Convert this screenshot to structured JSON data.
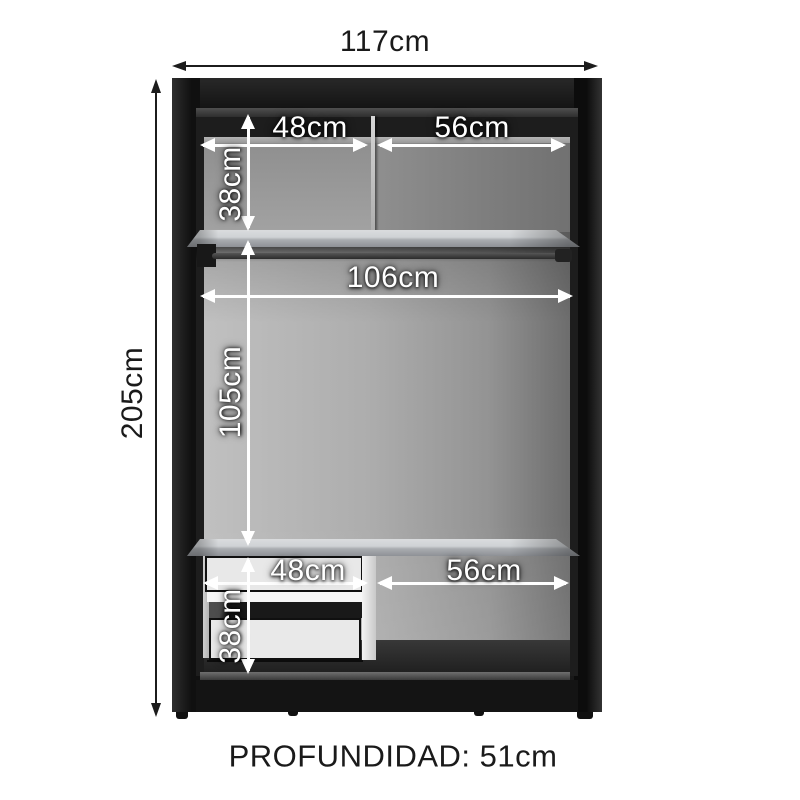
{
  "diagram": {
    "kind": "wardrobe-interior-dimensions",
    "overall": {
      "width": "117cm",
      "height": "205cm",
      "depth": "PROFUNDIDAD: 51cm"
    },
    "interior": {
      "top_left_width": "48cm",
      "top_right_width": "56cm",
      "top_section_height": "38cm",
      "rod_width": "106cm",
      "hanging_height": "105cm",
      "bottom_left_width": "48cm",
      "bottom_right_width": "56cm",
      "bottom_section_height": "38cm"
    },
    "colors": {
      "background": "#ffffff",
      "frame": "#191919",
      "panel_light": "#c0c0c0",
      "panel_dark": "#6d6d6d",
      "inside_label": "#ffffff",
      "outside_label": "#1a1a1a"
    }
  }
}
